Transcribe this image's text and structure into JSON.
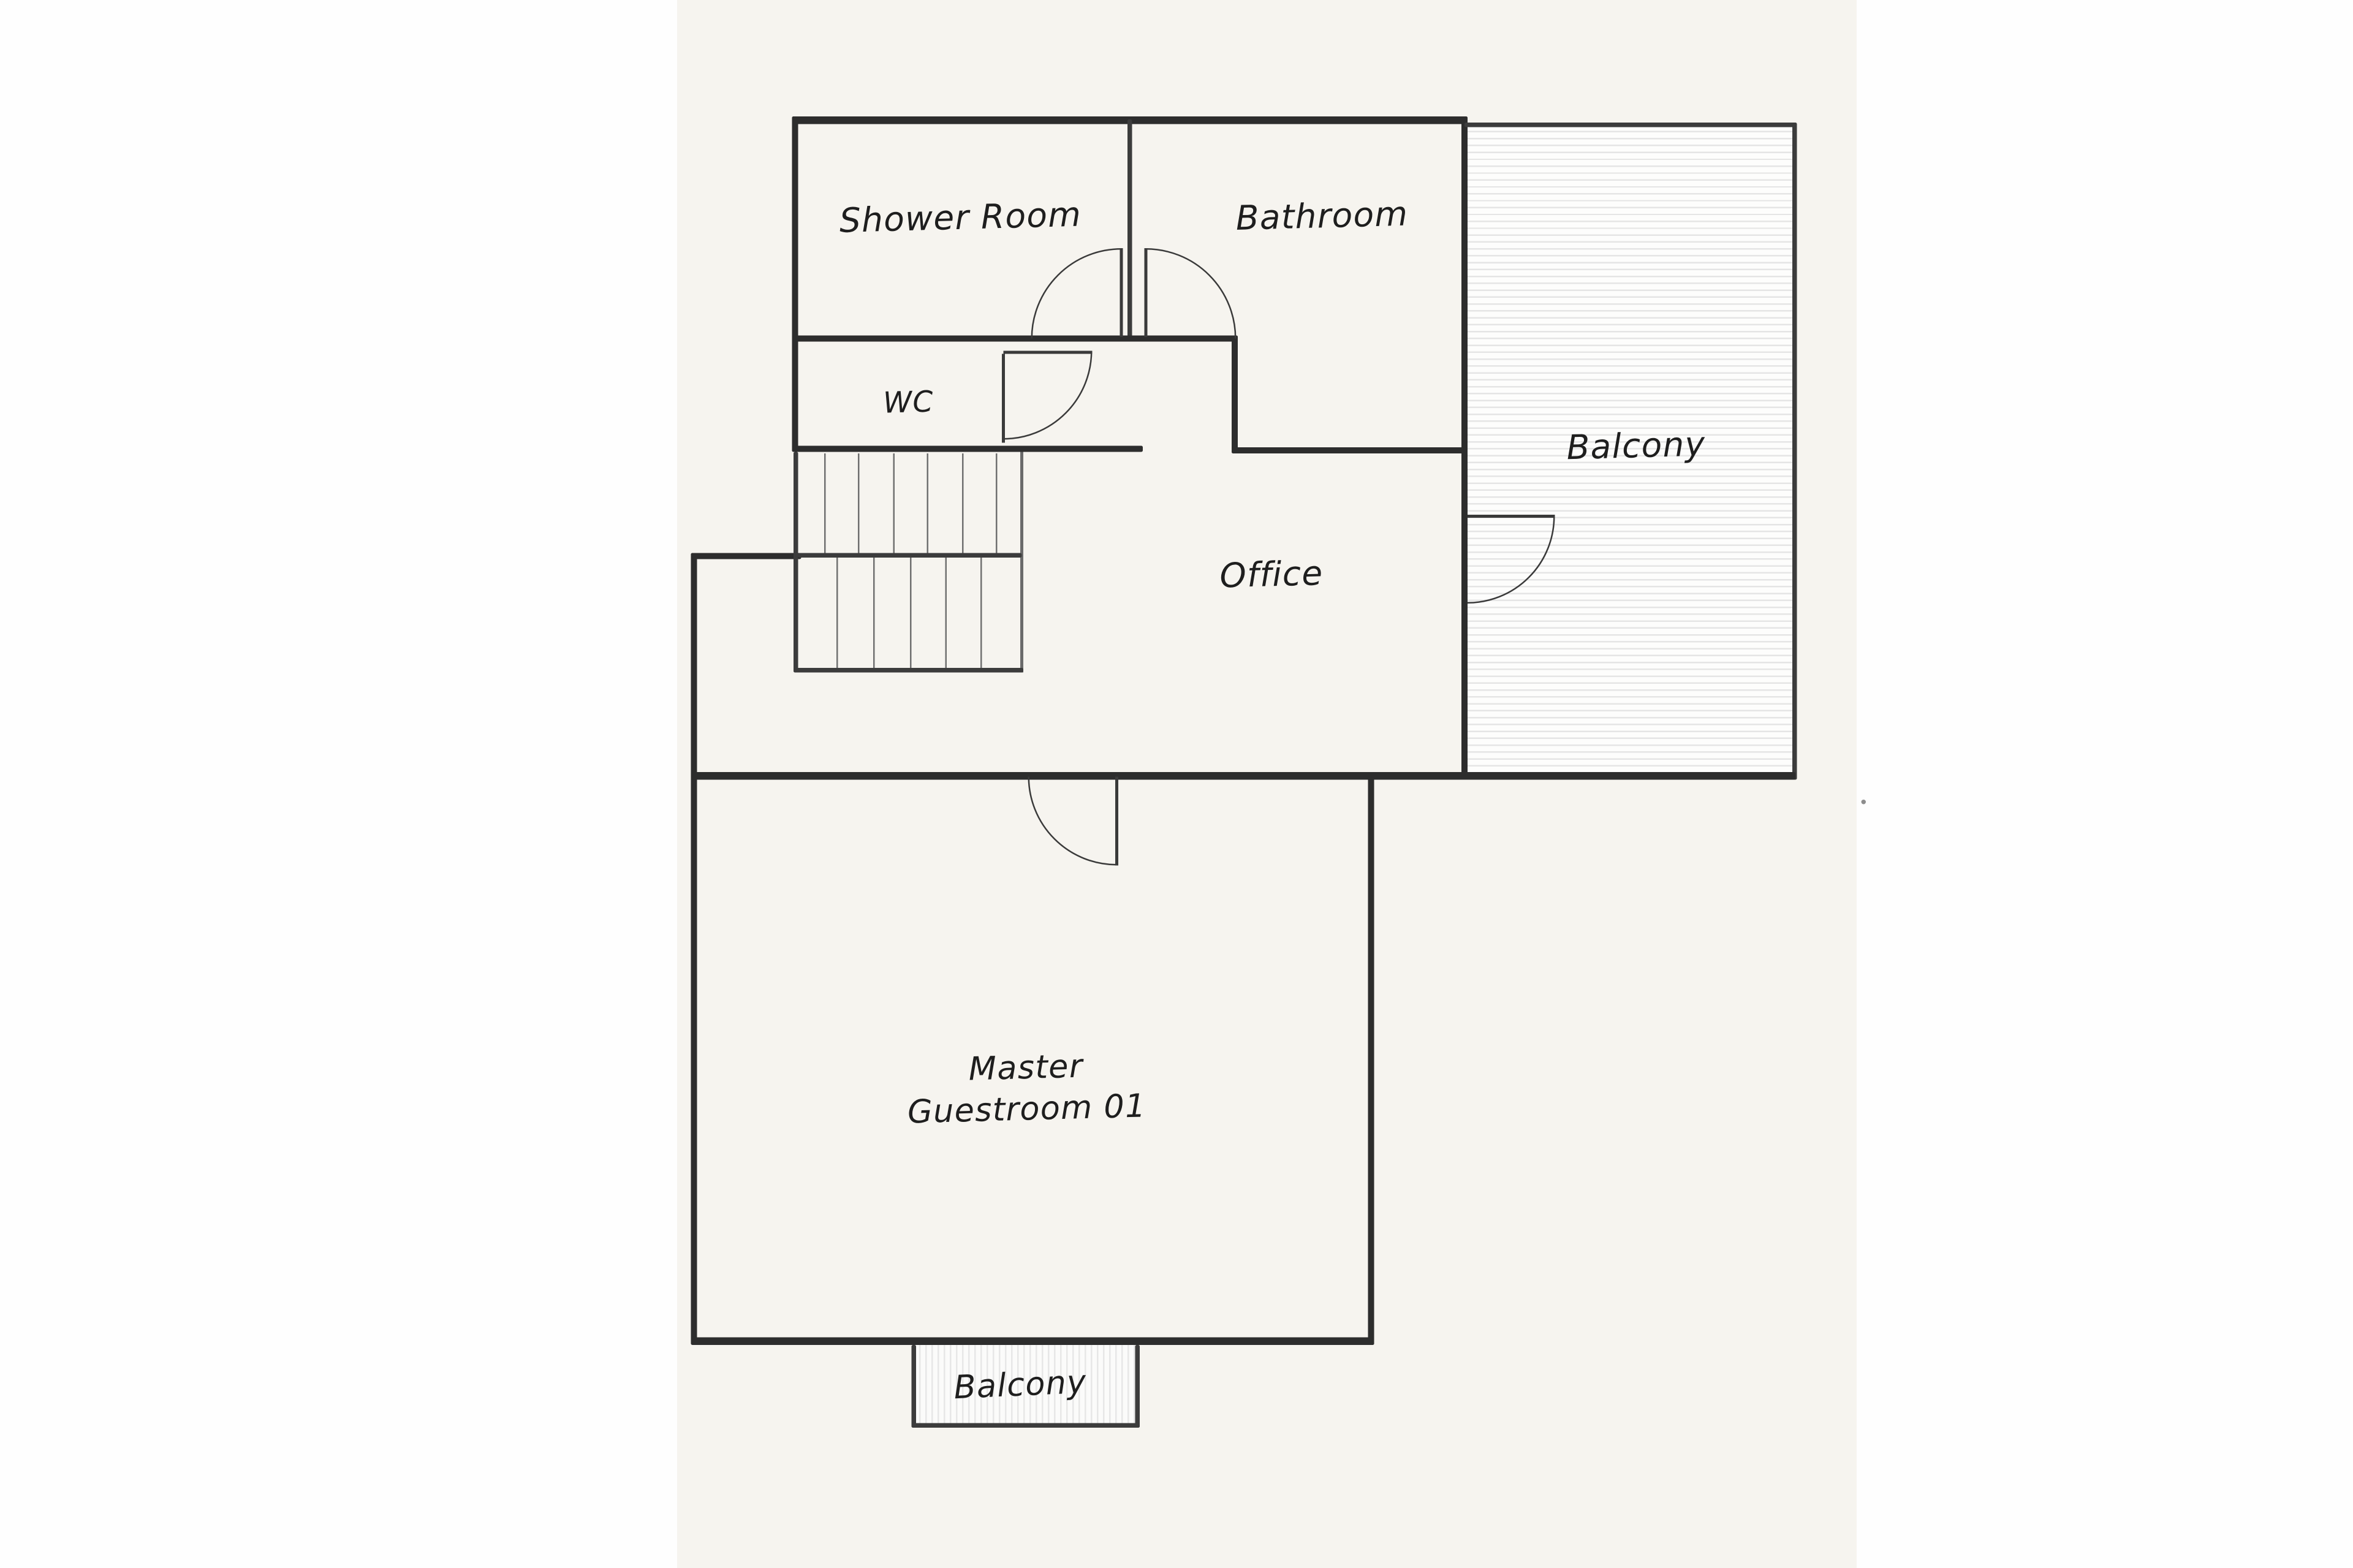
{
  "plan": {
    "type": "floor-plan-sketch",
    "rooms": {
      "shower_room": {
        "label": "Shower Room"
      },
      "bathroom": {
        "label": "Bathroom"
      },
      "wc": {
        "label": "WC"
      },
      "balcony_right": {
        "label": "Balcony"
      },
      "office": {
        "label": "Office"
      },
      "master_guestroom": {
        "label_line1": "Master",
        "label_line2": "Guestroom 01"
      },
      "balcony_bottom": {
        "label": "Balcony"
      }
    },
    "features": {
      "staircase": "double flight with landing",
      "doors": [
        "shower-room-door",
        "bathroom-door",
        "wc-door",
        "office-balcony-door",
        "master-guestroom-door"
      ]
    },
    "colors": {
      "wall": "#2d2d2d",
      "paper": "#f6f4ef",
      "background": "#fefefe",
      "hatch_line": "#e5e5e5"
    }
  }
}
